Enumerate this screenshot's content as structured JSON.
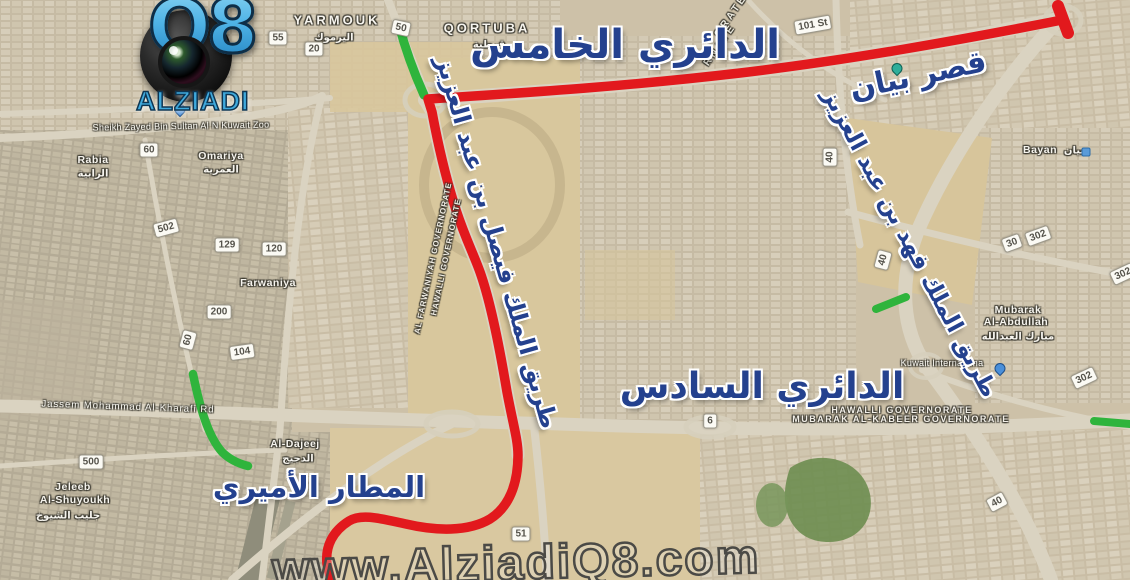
{
  "logo": {
    "q8": "Q8",
    "name": "ALZIADI"
  },
  "watermark": "www.AlziadiQ8.com",
  "annotations": {
    "fifth_ring": "الدائري الخامس",
    "bayan_palace": "قصر بيان",
    "king_fahd_road": "طريق الملك فهد بن عبد العزيز",
    "king_faisal_road": "طريق الملك فيصل بن عبد العزيز",
    "sixth_ring": "الدائري السادس",
    "amiri_airport": "المطار الأميري"
  },
  "colors": {
    "route_red": "#e2191d",
    "route_green": "#2fb43c",
    "annotation_blue": "#24418e",
    "logo_blue": "#45b1e6"
  },
  "route_shields": [
    {
      "label": "55",
      "x": 278,
      "y": 38,
      "rot": 0
    },
    {
      "label": "20",
      "x": 314,
      "y": 49,
      "rot": 0
    },
    {
      "label": "50",
      "x": 401,
      "y": 28,
      "rot": 12
    },
    {
      "label": "60",
      "x": 149,
      "y": 150,
      "rot": 0
    },
    {
      "label": "502",
      "x": 166,
      "y": 228,
      "rot": -15
    },
    {
      "label": "129",
      "x": 227,
      "y": 245,
      "rot": 0
    },
    {
      "label": "120",
      "x": 274,
      "y": 249,
      "rot": 0
    },
    {
      "label": "200",
      "x": 219,
      "y": 312,
      "rot": 0
    },
    {
      "label": "60",
      "x": 188,
      "y": 340,
      "rot": -75
    },
    {
      "label": "104",
      "x": 242,
      "y": 352,
      "rot": -8
    },
    {
      "label": "500",
      "x": 91,
      "y": 462,
      "rot": 0
    },
    {
      "label": "6",
      "x": 710,
      "y": 421,
      "rot": 0
    },
    {
      "label": "51",
      "x": 521,
      "y": 534,
      "rot": 0
    },
    {
      "label": "40",
      "x": 830,
      "y": 157,
      "rot": -90
    },
    {
      "label": "40",
      "x": 883,
      "y": 260,
      "rot": -75
    },
    {
      "label": "30",
      "x": 1012,
      "y": 243,
      "rot": -20
    },
    {
      "label": "302",
      "x": 1038,
      "y": 236,
      "rot": -20
    },
    {
      "label": "302",
      "x": 1123,
      "y": 274,
      "rot": -25
    },
    {
      "label": "302",
      "x": 1084,
      "y": 378,
      "rot": -25
    },
    {
      "label": "40",
      "x": 997,
      "y": 502,
      "rot": -28
    },
    {
      "label": "101 St",
      "x": 813,
      "y": 25,
      "rot": -10
    }
  ],
  "map_labels": [
    {
      "text": "YARMOUK",
      "x": 337,
      "y": 20,
      "cls": "district",
      "rot": 0
    },
    {
      "text": "اليرموك",
      "x": 334,
      "y": 38,
      "cls": "district-ar",
      "rot": 0
    },
    {
      "text": "QORTUBA",
      "x": 487,
      "y": 28,
      "cls": "district",
      "rot": 0
    },
    {
      "text": "قرطبة",
      "x": 489,
      "y": 45,
      "cls": "district-ar",
      "rot": 0
    },
    {
      "text": "Rabia",
      "x": 93,
      "y": 160,
      "cls": "district-sm",
      "rot": 0
    },
    {
      "text": "الرابية",
      "x": 93,
      "y": 174,
      "cls": "district-ar",
      "rot": 0
    },
    {
      "text": "Omariya",
      "x": 221,
      "y": 156,
      "cls": "district-sm",
      "rot": 0
    },
    {
      "text": "العمرية",
      "x": 221,
      "y": 170,
      "cls": "district-ar",
      "rot": 0
    },
    {
      "text": "Farwaniya",
      "x": 268,
      "y": 283,
      "cls": "district-sm",
      "rot": 0
    },
    {
      "text": "Jeleeb",
      "x": 73,
      "y": 487,
      "cls": "district-sm",
      "rot": 0
    },
    {
      "text": "Al-Shuyoukh",
      "x": 75,
      "y": 500,
      "cls": "district-sm",
      "rot": 0
    },
    {
      "text": "جليب الشيوخ",
      "x": 68,
      "y": 516,
      "cls": "district-ar",
      "rot": 0
    },
    {
      "text": "Al-Dajeej",
      "x": 295,
      "y": 444,
      "cls": "district-sm",
      "rot": 0
    },
    {
      "text": "الدجيج",
      "x": 298,
      "y": 459,
      "cls": "district-ar",
      "rot": 0
    },
    {
      "text": "Bayan",
      "x": 1040,
      "y": 150,
      "cls": "district-sm",
      "rot": 0
    },
    {
      "text": "بيان",
      "x": 1074,
      "y": 151,
      "cls": "district-ar",
      "rot": 0
    },
    {
      "text": "Mubarak",
      "x": 1018,
      "y": 310,
      "cls": "district-sm",
      "rot": 0
    },
    {
      "text": "Al-Abdullah",
      "x": 1016,
      "y": 322,
      "cls": "district-sm",
      "rot": 0
    },
    {
      "text": "مبارك العبدالله",
      "x": 1018,
      "y": 337,
      "cls": "district-ar",
      "rot": 0
    },
    {
      "text": "Kuwait Internationa",
      "x": 942,
      "y": 363,
      "cls": "poi",
      "rot": 0
    },
    {
      "text": "Sheikh Zayed Bin Sultan Al N Kuwait Zoo",
      "x": 181,
      "y": 126,
      "cls": "poi",
      "rot": -1
    },
    {
      "text": "Jassem Mohammad Al-Kharafi Rd",
      "x": 128,
      "y": 407,
      "cls": "road",
      "rot": 2
    },
    {
      "text": "HAWALLI GOVERNORATE",
      "x": 902,
      "y": 410,
      "cls": "gov",
      "rot": 0
    },
    {
      "text": "MUBARAK AL-KABEER GOVERNORATE",
      "x": 901,
      "y": 419,
      "cls": "gov",
      "rot": 0
    },
    {
      "text": "HAWALLI GOVERNORATE",
      "x": 446,
      "y": 257,
      "cls": "gov-diag",
      "rot": -78
    },
    {
      "text": "AL FARWANIYAH GOVERNORATE",
      "x": 433,
      "y": 258,
      "cls": "gov-diag",
      "rot": -78
    },
    {
      "text": "ORATE",
      "x": 731,
      "y": 16,
      "cls": "gov-frag",
      "rot": -55
    },
    {
      "text": "RNATE",
      "x": 720,
      "y": 45,
      "cls": "gov-frag",
      "rot": -55
    }
  ]
}
